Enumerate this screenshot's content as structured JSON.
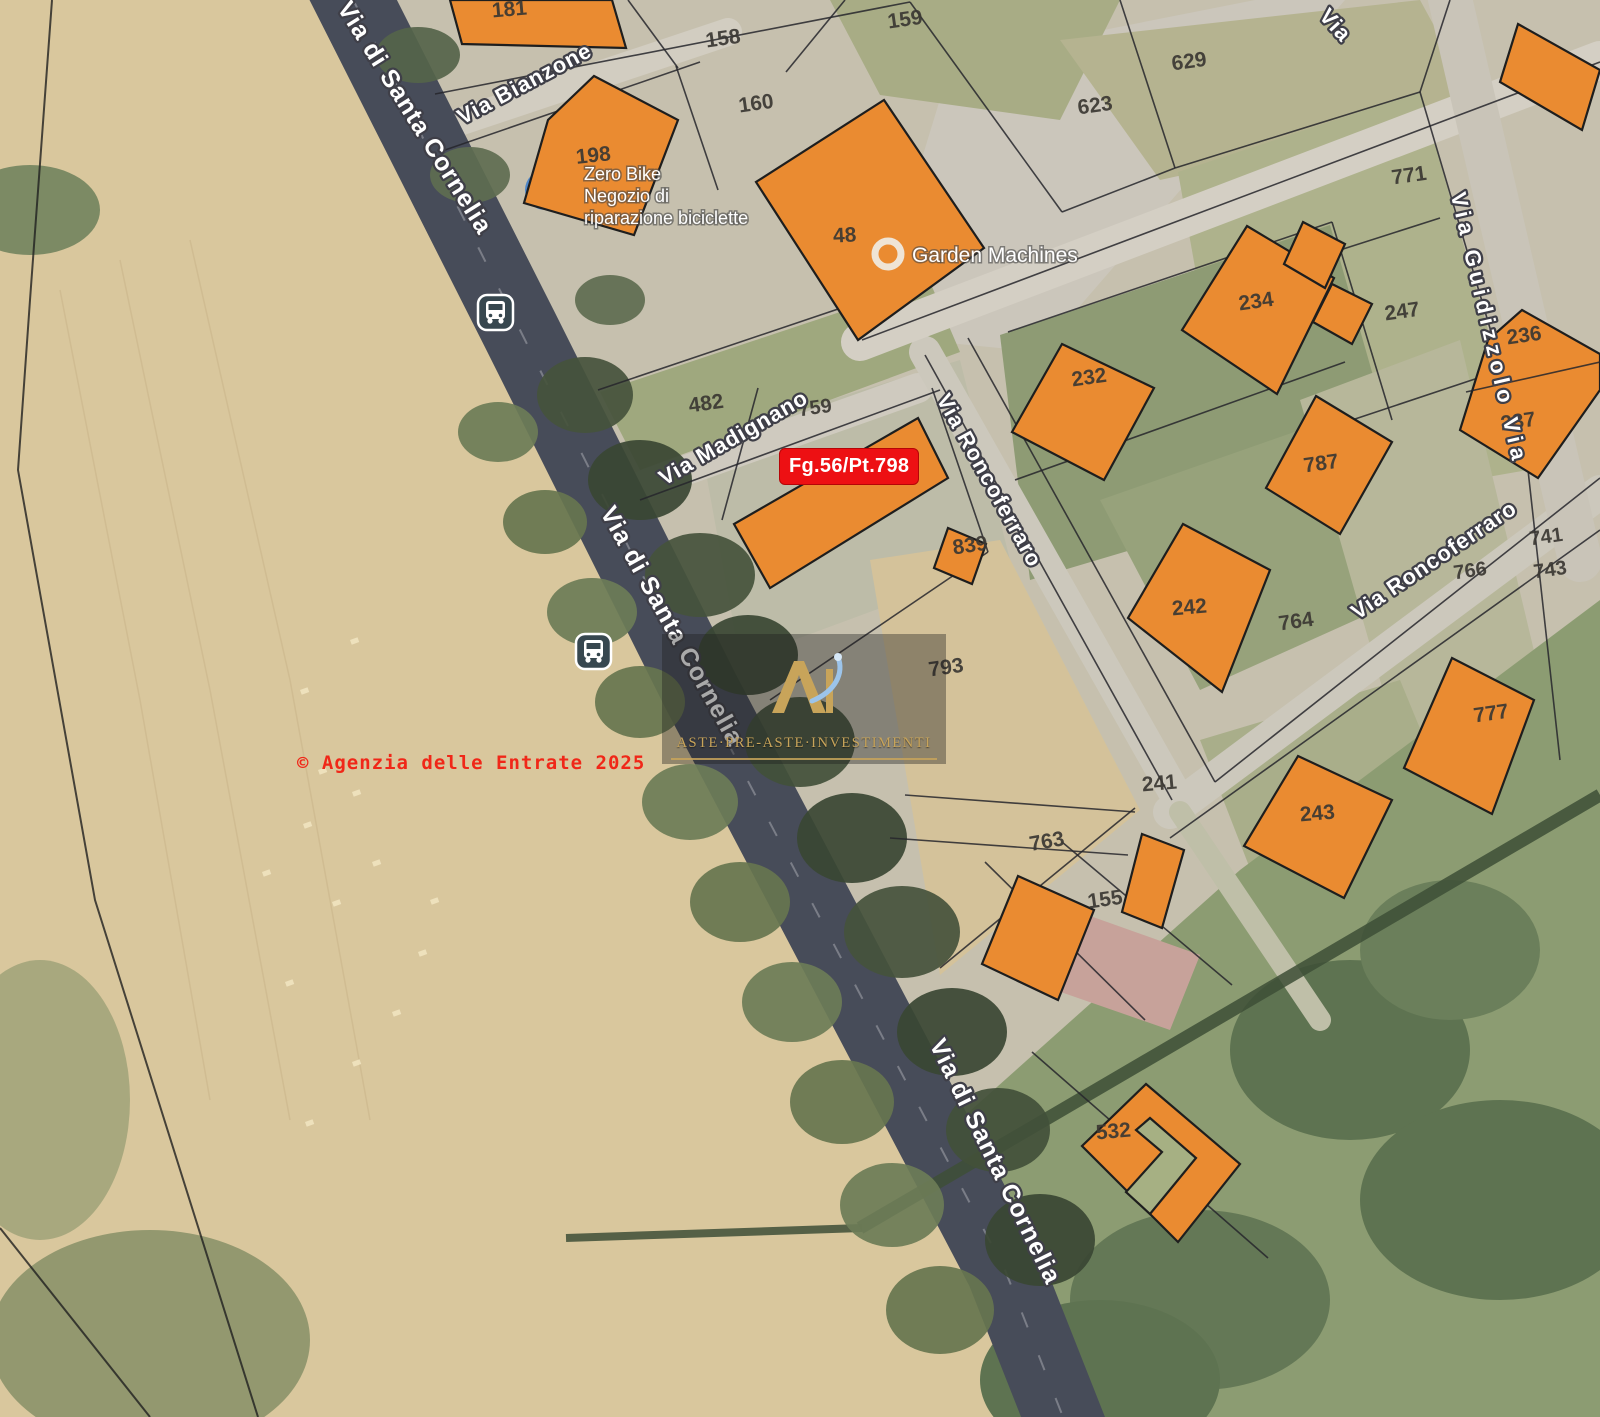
{
  "annotations": {
    "parcel_tag": "Fg.56/Pt.798",
    "copyright": "© Agenzia delle Entrate 2025",
    "watermark_text": "ASTE·PRE-ASTE·INVESTIMENTI"
  },
  "colors": {
    "building_fill": "#EA8B31",
    "building_stroke": "#1E1E1E",
    "parcel_number": "#3B3833",
    "boundary_line": "#26262C",
    "street_text": "#FFFFFF",
    "street_halo": "#3F3F48",
    "tag_red": "#ED1013",
    "main_road": "#474C59",
    "transit_icon_bg": "#37474F",
    "watermark_gold": "#C8A45A",
    "watermark_blue": "#9CC4EA"
  },
  "streets": [
    {
      "label": "Via di Santa Cornelia",
      "x": 408,
      "y": 122,
      "rot": 58,
      "size": 25
    },
    {
      "label": "Via di Santa Cornelia",
      "x": 665,
      "y": 630,
      "rot": 61,
      "size": 25
    },
    {
      "label": "Via di Santa Cornelia",
      "x": 988,
      "y": 1165,
      "rot": 64,
      "size": 25
    },
    {
      "label": "Via Bianzone",
      "x": 528,
      "y": 90,
      "rot": -28,
      "size": 22
    },
    {
      "label": "Via Madignano",
      "x": 737,
      "y": 444,
      "rot": -30,
      "size": 22
    },
    {
      "label": "Via Roncoferraro",
      "x": 983,
      "y": 484,
      "rot": 61,
      "size": 22
    },
    {
      "label": "Via Roncoferraro",
      "x": 1438,
      "y": 566,
      "rot": -34,
      "size": 22
    },
    {
      "label": "Via Guidizzolo Via",
      "x": 1482,
      "y": 330,
      "rot": 77,
      "size": 22,
      "ls": 5
    },
    {
      "label": "Via",
      "x": 1330,
      "y": 30,
      "rot": 48,
      "size": 22
    }
  ],
  "pois": {
    "zero_bike": {
      "lines": [
        "Zero Bike",
        "Negozio di",
        "riparazione biciclette"
      ],
      "x": 584,
      "y": 180,
      "line_h": 22,
      "size": 18
    },
    "garden_machines": {
      "label": "Garden Machines",
      "x": 912,
      "y": 262,
      "size": 21,
      "icon_x": 888,
      "icon_y": 254
    }
  },
  "parcels": [
    {
      "n": "181",
      "x": 510,
      "y": 16,
      "rot": -5
    },
    {
      "n": "158",
      "x": 724,
      "y": 45,
      "rot": -8
    },
    {
      "n": "159",
      "x": 906,
      "y": 26,
      "rot": -8
    },
    {
      "n": "160",
      "x": 757,
      "y": 110,
      "rot": -8
    },
    {
      "n": "623",
      "x": 1096,
      "y": 112,
      "rot": -8
    },
    {
      "n": "629",
      "x": 1190,
      "y": 68,
      "rot": -8
    },
    {
      "n": "198",
      "x": 594,
      "y": 162,
      "rot": -6
    },
    {
      "n": "48",
      "x": 845,
      "y": 242,
      "rot": -3
    },
    {
      "n": "771",
      "x": 1410,
      "y": 182,
      "rot": -8
    },
    {
      "n": "234",
      "x": 1257,
      "y": 308,
      "rot": -8
    },
    {
      "n": "247",
      "x": 1403,
      "y": 318,
      "rot": -8
    },
    {
      "n": "236",
      "x": 1525,
      "y": 342,
      "rot": -8
    },
    {
      "n": "232",
      "x": 1090,
      "y": 384,
      "rot": -8
    },
    {
      "n": "237",
      "x": 1519,
      "y": 428,
      "rot": -8
    },
    {
      "n": "482",
      "x": 707,
      "y": 410,
      "rot": -8
    },
    {
      "n": "759",
      "x": 816,
      "y": 414,
      "rot": -8,
      "size": 20
    },
    {
      "n": "787",
      "x": 1322,
      "y": 470,
      "rot": -8
    },
    {
      "n": "839",
      "x": 971,
      "y": 552,
      "rot": -8
    },
    {
      "n": "741",
      "x": 1547,
      "y": 543,
      "rot": -8,
      "size": 20
    },
    {
      "n": "766",
      "x": 1471,
      "y": 577,
      "rot": -8,
      "size": 20
    },
    {
      "n": "743",
      "x": 1551,
      "y": 576,
      "rot": -8,
      "size": 20
    },
    {
      "n": "242",
      "x": 1190,
      "y": 614,
      "rot": -5
    },
    {
      "n": "764",
      "x": 1297,
      "y": 628,
      "rot": -8
    },
    {
      "n": "793",
      "x": 947,
      "y": 674,
      "rot": -8
    },
    {
      "n": "777",
      "x": 1492,
      "y": 720,
      "rot": -8
    },
    {
      "n": "241",
      "x": 1160,
      "y": 790,
      "rot": -5
    },
    {
      "n": "243",
      "x": 1318,
      "y": 820,
      "rot": -5
    },
    {
      "n": "763",
      "x": 1048,
      "y": 848,
      "rot": -10
    },
    {
      "n": "155",
      "x": 1106,
      "y": 906,
      "rot": -8
    },
    {
      "n": "532",
      "x": 1114,
      "y": 1138,
      "rot": -5
    }
  ],
  "transit_stops": [
    {
      "x": 478,
      "y": 295
    },
    {
      "x": 576,
      "y": 634
    }
  ],
  "geometry": {
    "field": {
      "pts": "0,0 335,0 540,400 760,830 900,1130 1030,1417 0,1417",
      "fill": "#D9C79D"
    },
    "base": {
      "pts": "335,0 1600,0 1600,1417 1030,1417 900,1130 760,830 540,400",
      "fill": "#C6C0AE"
    },
    "patches": [
      {
        "t": "p",
        "pts": "868,335 952,60 1255,0 1345,0 1040,352",
        "f": "#CBC6BB"
      },
      {
        "t": "p",
        "pts": "830,0 1120,0 1060,120 880,95",
        "f": "#A8AC85"
      },
      {
        "t": "p",
        "pts": "1060,40 1420,0 1480,110 1160,180",
        "f": "#B5B390"
      },
      {
        "t": "p",
        "pts": "1178,172 1420,92 1528,470 1240,520",
        "f": "#AEB28C"
      },
      {
        "t": "p",
        "pts": "1000,335 1330,225 1400,470 1030,580",
        "f": "#8E9B74"
      },
      {
        "t": "p",
        "pts": "700,440 960,360 1010,560 740,660",
        "f": "#BDBCA8"
      },
      {
        "t": "p",
        "pts": "600,392 930,282 960,352 640,470",
        "f": "#9FA87E"
      },
      {
        "t": "p",
        "pts": "870,560 1000,540 1140,810 940,975",
        "f": "#D4C29A"
      },
      {
        "t": "p",
        "pts": "1100,500 1300,430 1400,600 1200,690",
        "f": "#97A27B"
      },
      {
        "t": "p",
        "pts": "1300,400 1460,340 1560,760 1420,820",
        "f": "#B7B79A"
      },
      {
        "t": "p",
        "pts": "1200,740 1400,680 1470,850 1270,920",
        "f": "#A9AE8A"
      },
      {
        "t": "p",
        "pts": "1240,870 1600,600 1600,1417 1060,1417 960,1120",
        "f": "#8C9C72"
      },
      {
        "t": "p",
        "pts": "1062,906 1200,955 1170,1030 1032,982",
        "f": "#C7A29A"
      },
      {
        "t": "e",
        "cx": 1350,
        "cy": 1050,
        "rx": 120,
        "ry": 90,
        "f": "#5E7351"
      },
      {
        "t": "e",
        "cx": 1500,
        "cy": 1200,
        "rx": 140,
        "ry": 100,
        "f": "#5E7351"
      },
      {
        "t": "e",
        "cx": 1200,
        "cy": 1300,
        "rx": 130,
        "ry": 90,
        "f": "#647856"
      },
      {
        "t": "e",
        "cx": 1450,
        "cy": 950,
        "rx": 90,
        "ry": 70,
        "f": "#6B7F5B"
      },
      {
        "t": "e",
        "cx": 1100,
        "cy": 1380,
        "rx": 120,
        "ry": 80,
        "f": "#5E7351"
      },
      {
        "t": "e",
        "cx": 30,
        "cy": 210,
        "rx": 70,
        "ry": 45,
        "f": "#7C8A64"
      },
      {
        "t": "e",
        "cx": 150,
        "cy": 1340,
        "rx": 160,
        "ry": 110,
        "f": "#93986F"
      },
      {
        "t": "e",
        "cx": 40,
        "cy": 1100,
        "rx": 90,
        "ry": 140,
        "f": "#A8A87E"
      }
    ],
    "roads": [
      {
        "x1": 420,
        "y1": 135,
        "x2": 728,
        "y2": 32,
        "w": 28,
        "c": "#D2CDC1"
      },
      {
        "x1": 588,
        "y1": 505,
        "x2": 918,
        "y2": 388,
        "w": 30,
        "c": "#CFCABF"
      },
      {
        "x1": 925,
        "y1": 352,
        "x2": 1182,
        "y2": 806,
        "w": 32,
        "c": "#CCC8BC"
      },
      {
        "x1": 1170,
        "y1": 812,
        "x2": 1600,
        "y2": 492,
        "w": 34,
        "c": "#CCC8BC"
      },
      {
        "x1": 860,
        "y1": 342,
        "x2": 1600,
        "y2": 60,
        "w": 38,
        "c": "#D4CFC4"
      },
      {
        "x1": 1448,
        "y1": -10,
        "x2": 1580,
        "y2": 560,
        "w": 44,
        "c": "#C9C4B8"
      },
      {
        "x1": 1180,
        "y1": 812,
        "x2": 1320,
        "y2": 1020,
        "w": 22,
        "c": "#BFBFA8"
      }
    ],
    "main_road": {
      "d": "M333,-40 L520,330 L700,690 L800,880 L1005,1270 L1080,1460",
      "w": 78,
      "c": "#474C59"
    },
    "hedges": [
      {
        "x1": 860,
        "y1": 1228,
        "x2": 1600,
        "y2": 795,
        "w": 13
      },
      {
        "x1": 566,
        "y1": 1238,
        "x2": 862,
        "y2": 1228,
        "w": 8
      }
    ],
    "trees": [
      [
        585,
        395,
        48,
        38,
        "#45523C"
      ],
      [
        640,
        480,
        52,
        40,
        "#394633"
      ],
      [
        700,
        575,
        55,
        42,
        "#45523C"
      ],
      [
        748,
        655,
        50,
        40,
        "#394633"
      ],
      [
        800,
        742,
        55,
        45,
        "#42503A"
      ],
      [
        852,
        838,
        55,
        45,
        "#394633"
      ],
      [
        902,
        932,
        58,
        46,
        "#45523C"
      ],
      [
        952,
        1032,
        55,
        44,
        "#394633"
      ],
      [
        998,
        1130,
        52,
        42,
        "#42503A"
      ],
      [
        1040,
        1240,
        55,
        46,
        "#394633"
      ],
      [
        498,
        432,
        40,
        30,
        "#6D7C57"
      ],
      [
        545,
        522,
        42,
        32,
        "#67754F"
      ],
      [
        592,
        612,
        45,
        34,
        "#6D7C57"
      ],
      [
        640,
        702,
        45,
        36,
        "#67754F"
      ],
      [
        690,
        802,
        48,
        38,
        "#6D7C57"
      ],
      [
        740,
        902,
        50,
        40,
        "#67754F"
      ],
      [
        792,
        1002,
        50,
        40,
        "#6D7C57"
      ],
      [
        842,
        1102,
        52,
        42,
        "#67754F"
      ],
      [
        892,
        1205,
        52,
        42,
        "#6D7C57"
      ],
      [
        940,
        1310,
        54,
        44,
        "#67754F"
      ],
      [
        418,
        55,
        42,
        28,
        "#55644A"
      ],
      [
        470,
        175,
        40,
        28,
        "#5E6C50"
      ],
      [
        610,
        300,
        35,
        25,
        "#5E6C50"
      ]
    ],
    "fences": [
      "52,0 30,300 18,470 95,900 258,1417",
      "0,1228 150,1417"
    ],
    "stripes": [
      "60,290 140,700 210,1100",
      "120,260 210,690 290,1120",
      "190,240 290,680 370,1120"
    ],
    "bales": [
      [
        318,
        770
      ],
      [
        352,
        792
      ],
      [
        303,
        824
      ],
      [
        372,
        862
      ],
      [
        332,
        902
      ],
      [
        418,
        952
      ],
      [
        285,
        982
      ],
      [
        392,
        1012
      ],
      [
        352,
        1062
      ],
      [
        305,
        1122
      ],
      [
        262,
        872
      ],
      [
        430,
        900
      ],
      [
        350,
        640
      ],
      [
        300,
        690
      ]
    ],
    "lines": [
      "435,94 910,2",
      "628,0 678,68",
      "845,0 786,72",
      "910,2 1062,212",
      "1120,0 1175,168",
      "1175,168 1062,212",
      "862,340 1600,62",
      "1175,168 1420,92",
      "1420,92 1450,0",
      "1420,92 1532,470",
      "1340,250 1440,218",
      "1352,420 1478,378",
      "445,150 700,62",
      "676,66 718,190",
      "598,390 930,278",
      "640,500 940,390",
      "758,388 722,520",
      "932,388 988,552",
      "988,552 770,700",
      "925,355 1172,800",
      "968,338 1215,782",
      "1215,782 1600,478",
      "1170,838 1600,530",
      "1008,332 1332,222",
      "1015,480 1345,362",
      "1332,222 1392,420",
      "1135,808 940,968",
      "905,795 1135,812",
      "890,838 1128,855",
      "1062,842 1232,985",
      "985,862 1145,1020",
      "1528,470 1560,760",
      "1032,1052 1268,1258"
    ],
    "buildings": [
      {
        "pts": "450,0 612,0 626,48 462,44"
      },
      {
        "pts": "594,76 678,120 634,235 524,203 548,120"
      },
      {
        "pts": "884,100 984,248 858,340 756,182"
      },
      {
        "pts": "1247,226 1334,278 1277,394 1182,330"
      },
      {
        "pts": "1303,222 1345,244 1325,288 1284,264"
      },
      {
        "pts": "1332,284 1372,304 1352,344 1313,322"
      },
      {
        "pts": "1062,344 1154,388 1104,480 1012,432"
      },
      {
        "pts": "1522,310 1600,354 1600,390 1538,478 1460,430 1488,340"
      },
      {
        "pts": "1316,396 1392,442 1340,534 1266,488"
      },
      {
        "pts": "1183,524 1270,570 1222,692 1128,618"
      },
      {
        "pts": "918,418 948,478 770,588 734,524"
      },
      {
        "pts": "948,528 986,544 972,584 934,568"
      },
      {
        "pts": "1452,658 1534,700 1492,814 1404,768"
      },
      {
        "pts": "1298,756 1392,800 1344,898 1244,846"
      },
      {
        "pts": "1142,834 1184,850 1162,928 1122,912"
      },
      {
        "pts": "1018,876 1094,910 1058,1000 982,964"
      },
      {
        "pts": "1146,1084 1240,1164 1178,1242 1082,1146"
      },
      {
        "pts": "1150,1118 1196,1158 1150,1214 1126,1192 1162,1152 1136,1130",
        "f": "#A6B083"
      },
      {
        "pts": "1518,24 1600,70 1582,130 1500,82"
      }
    ],
    "overlines": [
      "1466,392 1600,362"
    ]
  }
}
